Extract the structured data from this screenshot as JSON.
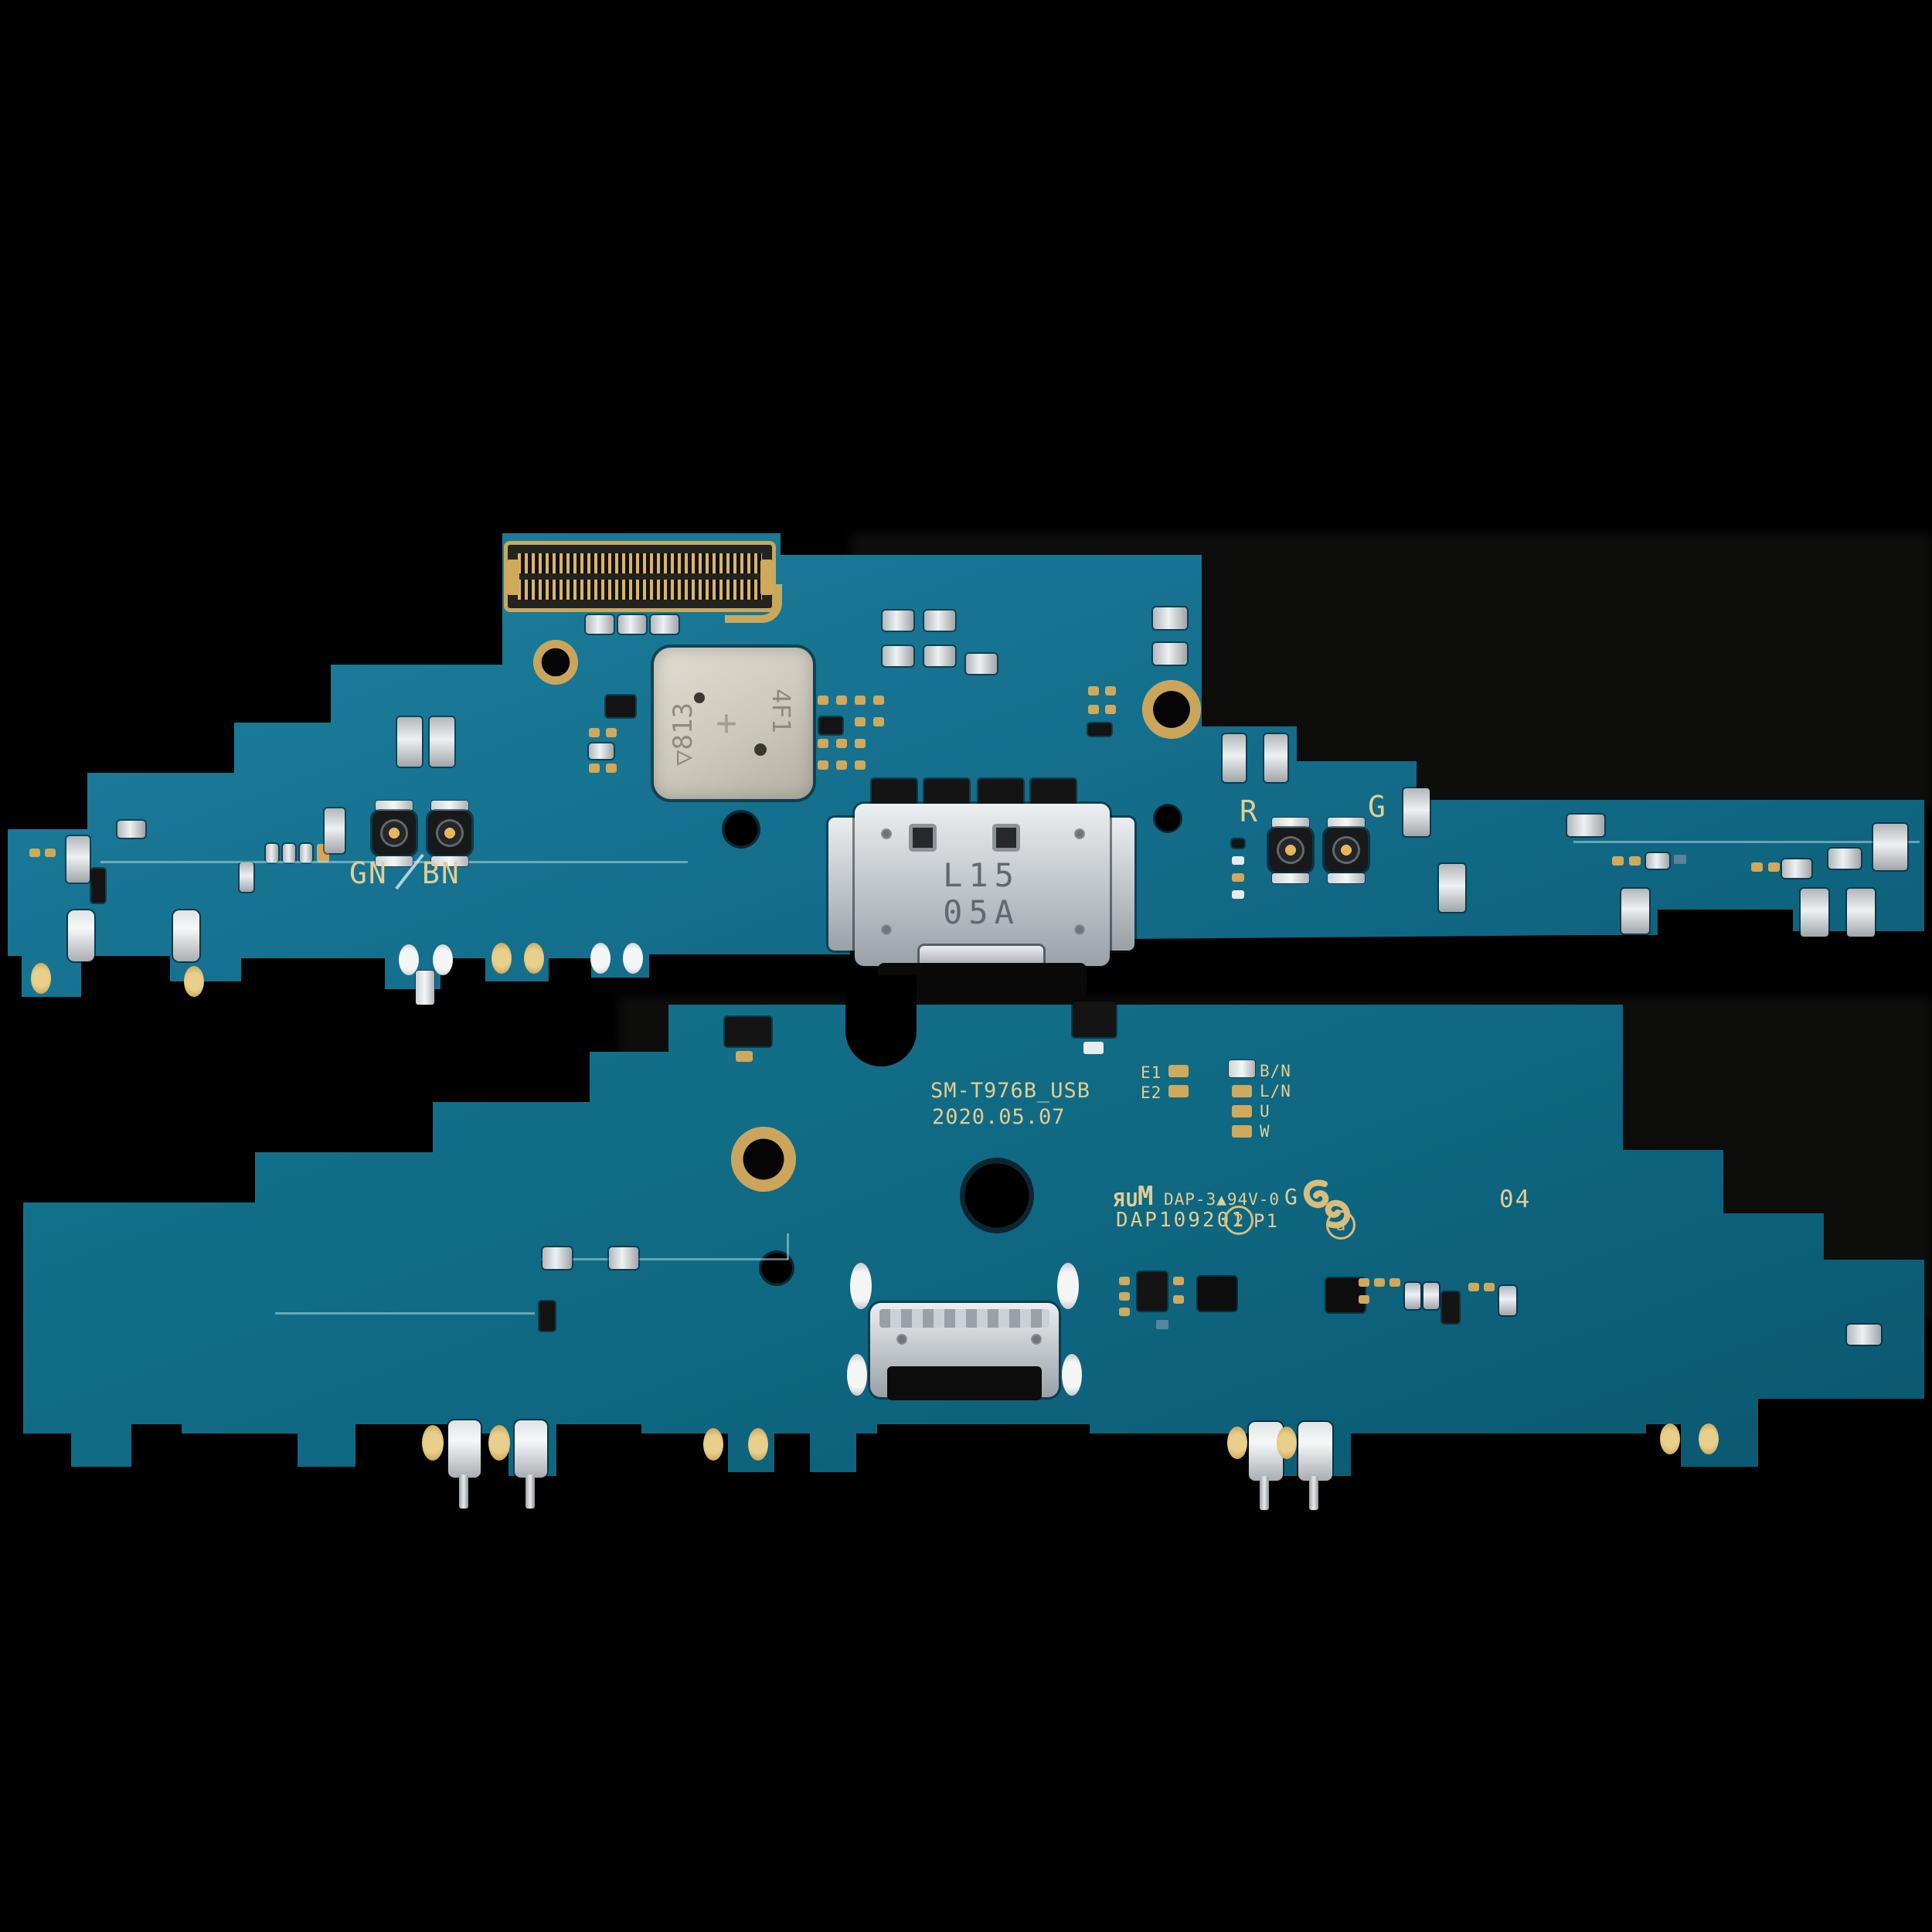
{
  "front_board": {
    "antenna_labels": {
      "gn": "GN",
      "bn": "BN",
      "r": "R",
      "g": "G"
    },
    "usb_marking": {
      "line1": "L15",
      "line2": "05A"
    },
    "shield_marking": {
      "left": "▽813",
      "center": "+",
      "right": "4F1"
    }
  },
  "back_board": {
    "model": "SM-T976B_USB",
    "date": "2020.05.07",
    "test_points": {
      "e1": "E1",
      "e2": "E2",
      "col": [
        "B/N",
        "L/N",
        "U",
        "W"
      ]
    },
    "cert": {
      "ul": "ЯU",
      "m": "M",
      "line1": "DAP-3▲94V-0",
      "line2": "DAP109201",
      "circled": "2",
      "rev": "P1",
      "g": "G",
      "at": "a"
    },
    "panel_number": "04"
  },
  "colors": {
    "background": "#000000",
    "pcb_front": "#15718f",
    "pcb_back": "#0f6781",
    "silkscreen": "#e2cd94",
    "gold_pad": "#cfa95c",
    "silver": "#e0e4e6",
    "shield": "#cdc8bc"
  }
}
